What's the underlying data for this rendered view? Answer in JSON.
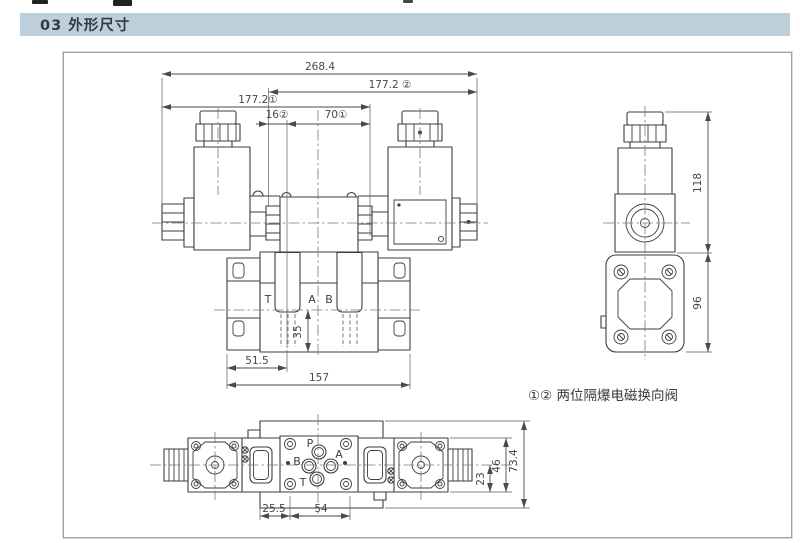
{
  "header": {
    "title": "03 外形尺寸"
  },
  "front_view": {
    "dims": {
      "overall_width": "268.4",
      "width_right": "177.2 ②",
      "width_left": "177.2①",
      "offset_16": "16②",
      "spacing_70": "70①",
      "depth_35": "35",
      "offset_51_5": "51.5",
      "base_width": "157"
    },
    "ports": {
      "t": "T",
      "a": "A",
      "b": "B"
    }
  },
  "side_view": {
    "dims": {
      "upper_height": "118",
      "lower_height": "96"
    }
  },
  "caption": {
    "text": "①② 两位隔爆电磁换向阀"
  },
  "bottom_view": {
    "ports": {
      "p": "P",
      "a": "A",
      "b": "B",
      "t": "T"
    },
    "dims": {
      "offset_25_5": "25.5",
      "spacing_54": "54",
      "center_to_edge": "23",
      "body_width": "46",
      "overall_height": "73.4"
    }
  }
}
